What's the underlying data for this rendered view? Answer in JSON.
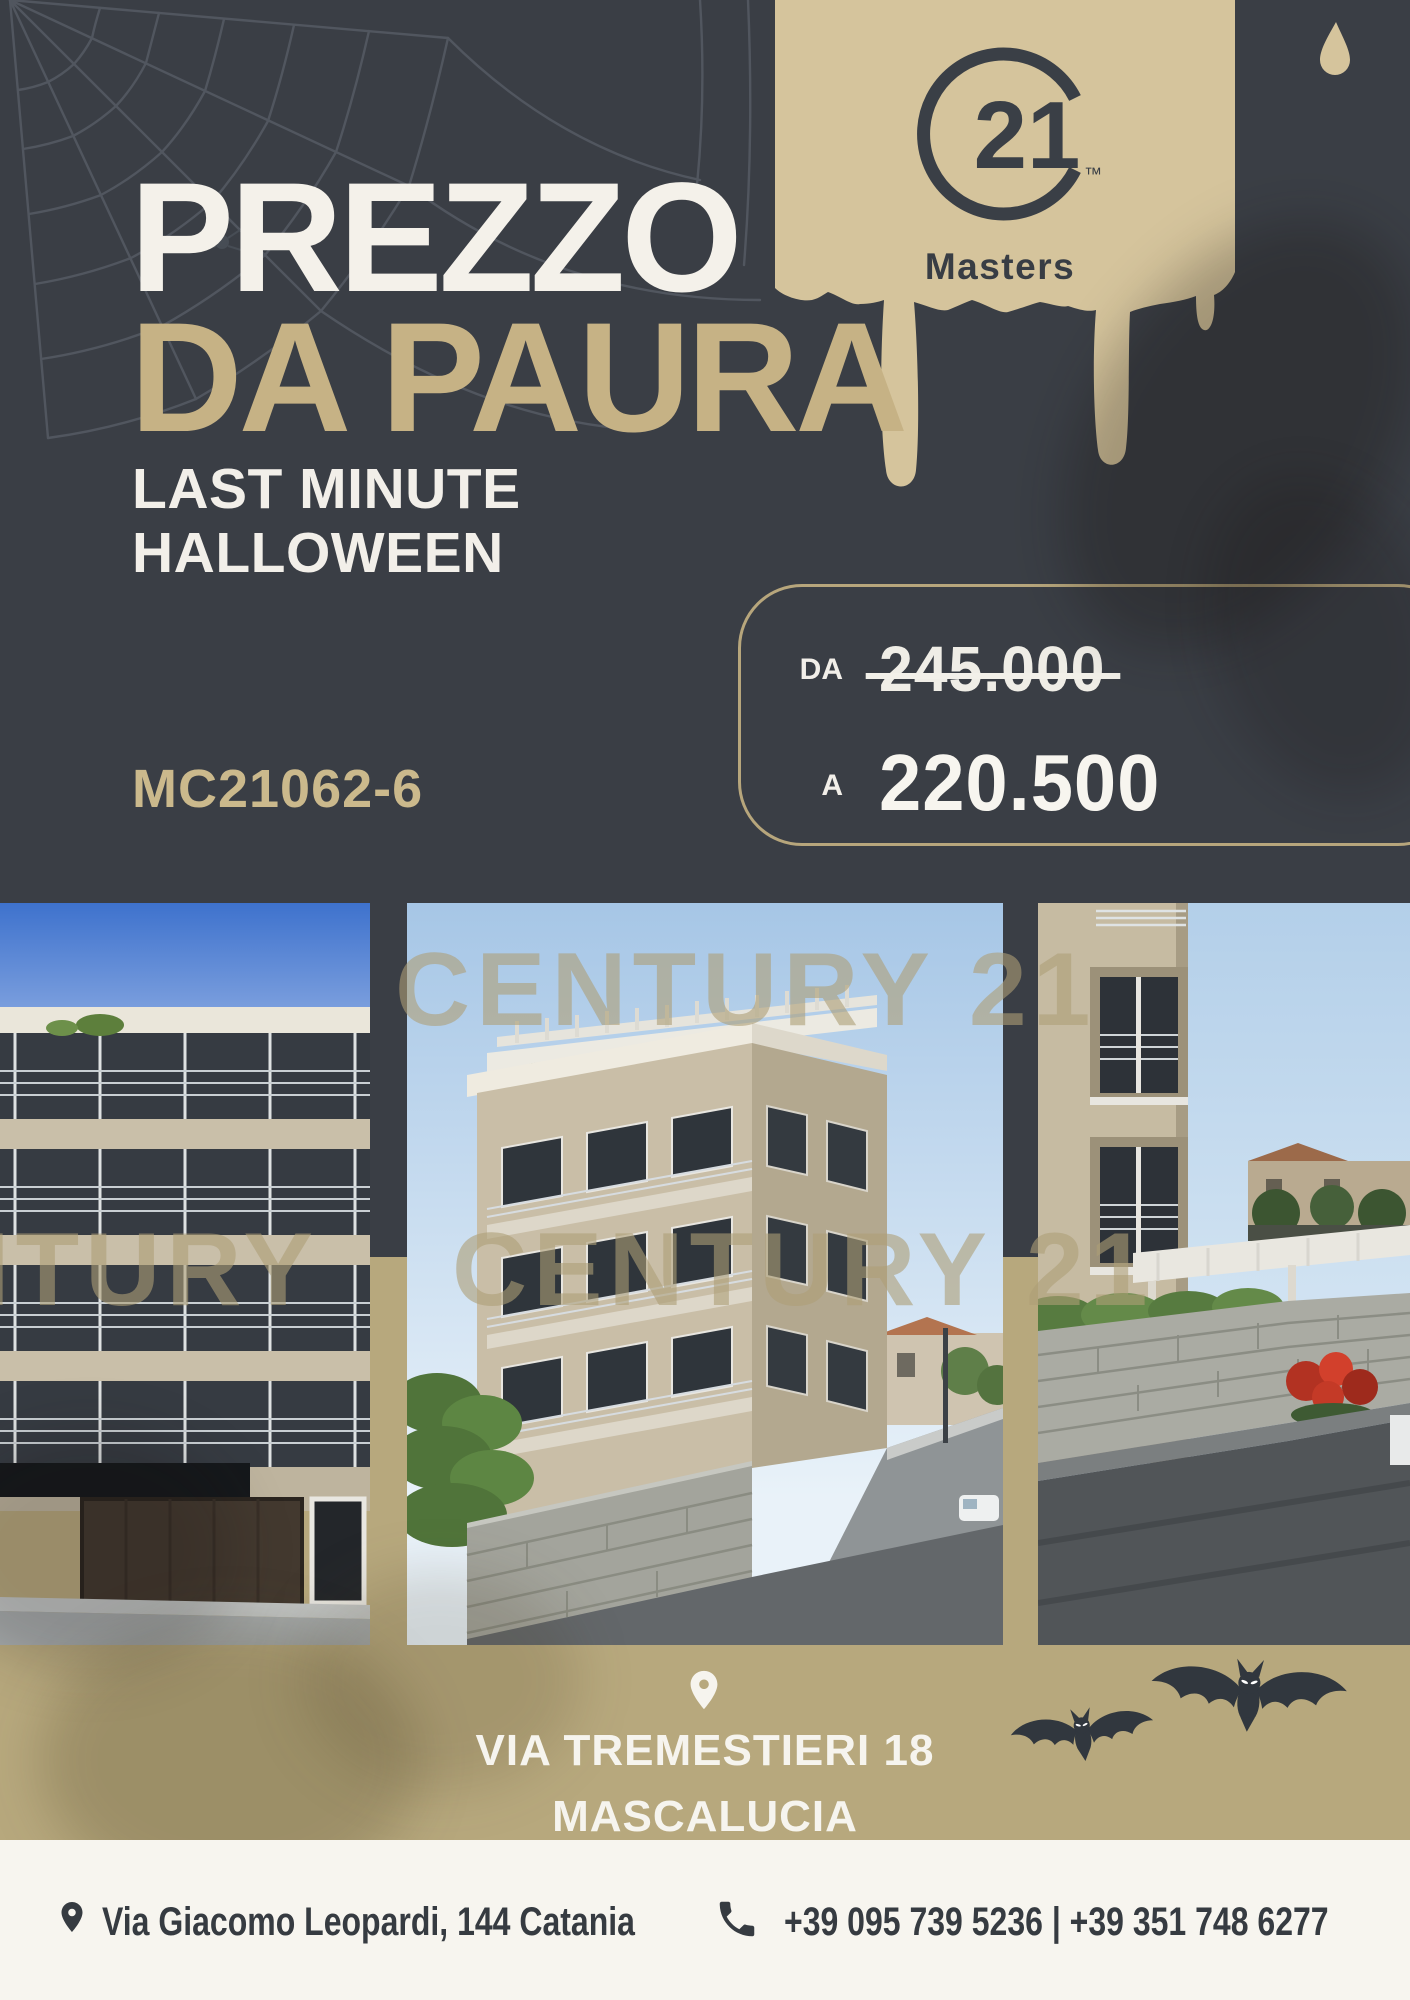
{
  "brand": {
    "logo_number": "21",
    "trademark": "™",
    "agency_name": "Masters",
    "watermark": "CENTURY 21"
  },
  "hero": {
    "title_line1": "PREZZO",
    "title_line2": "DA PAURA",
    "tagline_line1": "LAST MINUTE",
    "tagline_line2": "HALLOWEEN",
    "listing_code": "MC21062-6"
  },
  "price": {
    "from_label": "DA",
    "from_value": "245.000",
    "to_label": "A",
    "to_value": "220.500"
  },
  "location": {
    "line1": "VIA TREMESTIERI 18",
    "line2": "MASCALUCIA"
  },
  "footer": {
    "address": "Via Giacomo Leopardi, 144 Catania",
    "phones": "+39 095 739 5236 | +39 351 748 6277"
  },
  "colors": {
    "background": "#3a3e45",
    "gold_band": "#b7a87d",
    "gold_drip": "#d5c49c",
    "title_gold": "#c6b285",
    "white": "#f4f1ea",
    "footer_bg": "#f7f5ef",
    "dark_text": "#363b41"
  }
}
